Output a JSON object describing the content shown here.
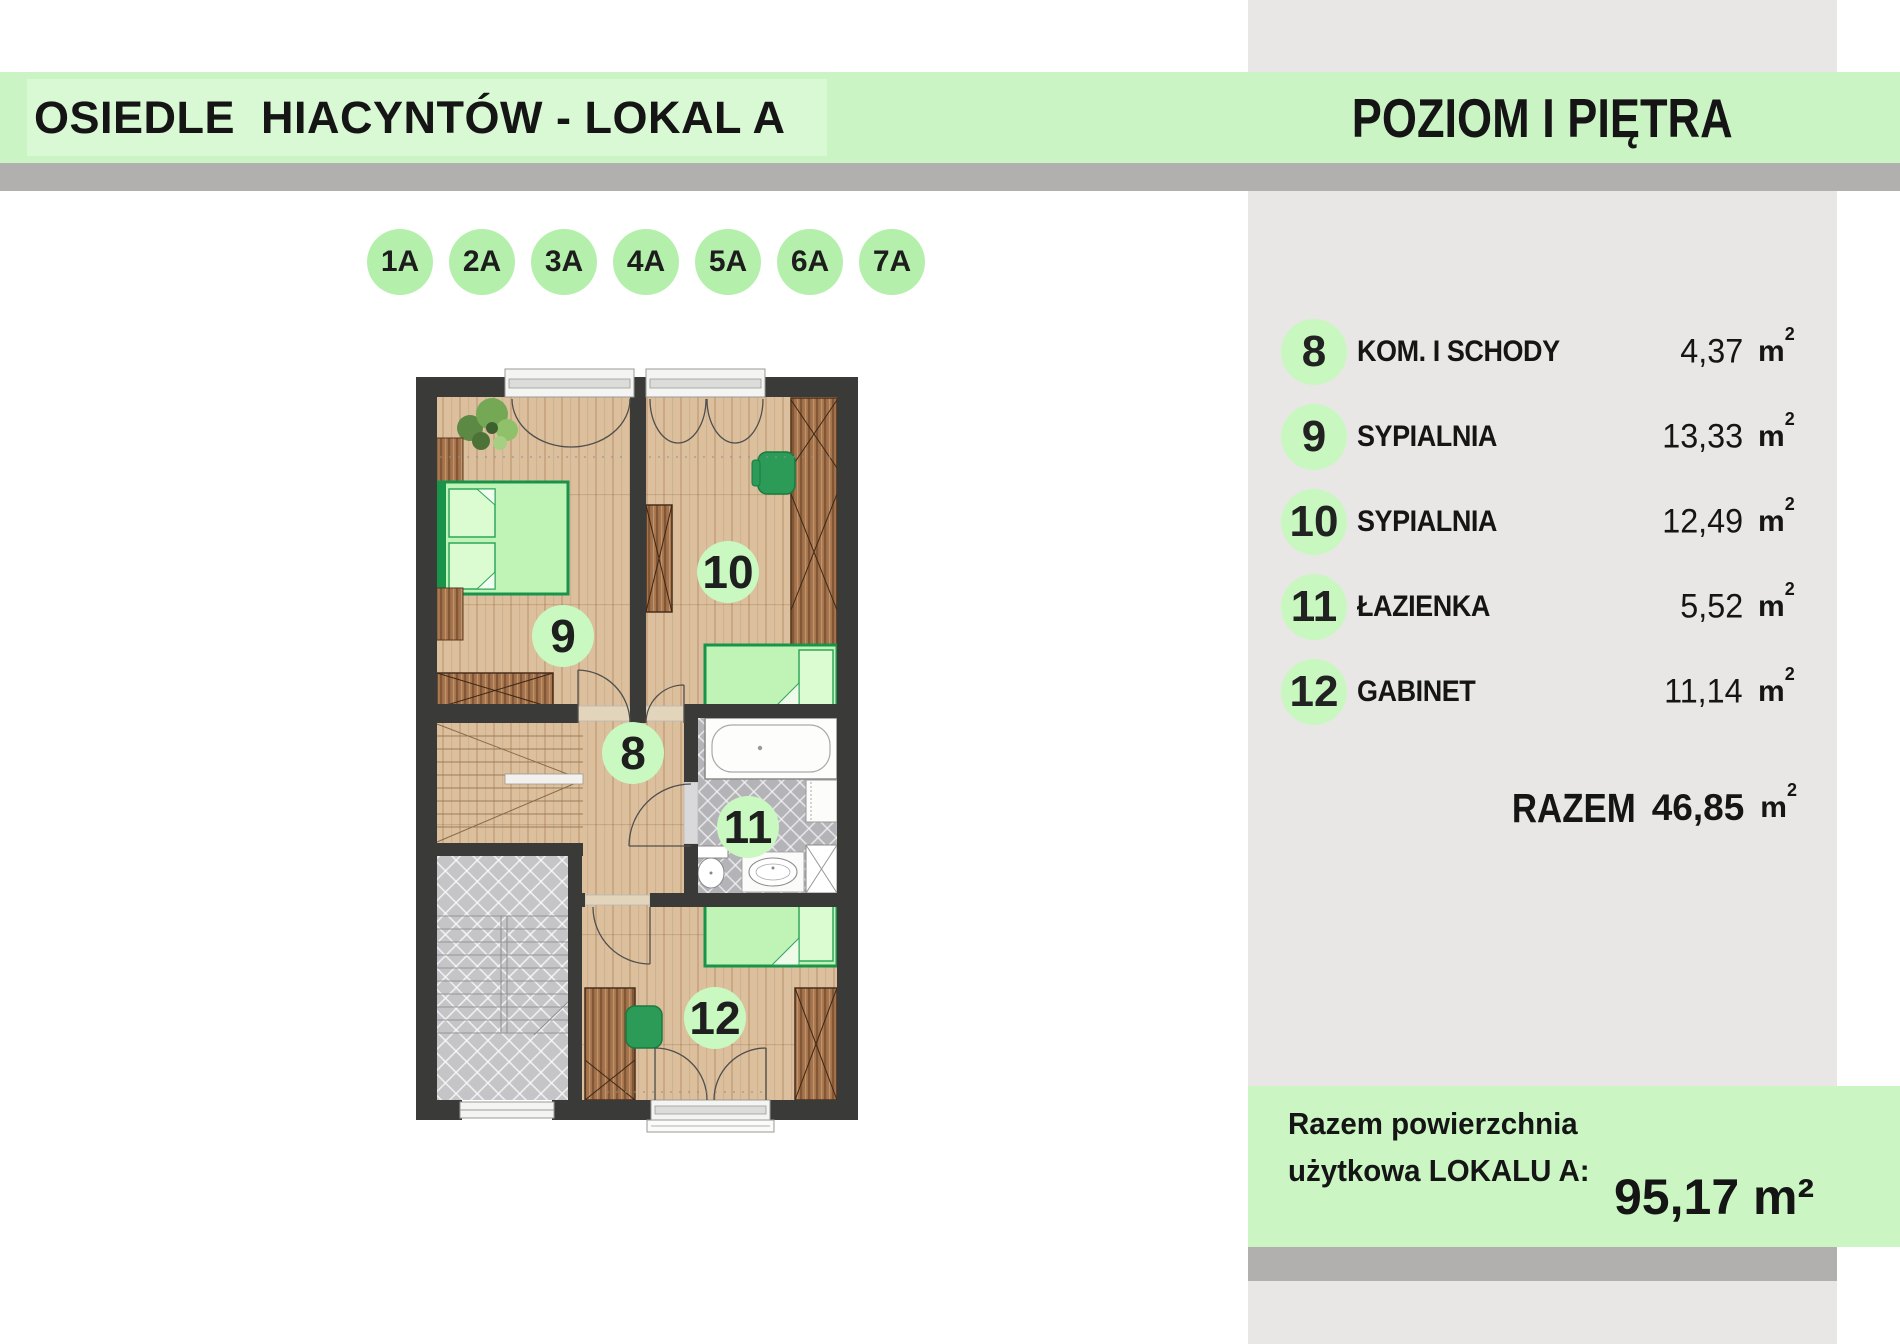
{
  "header": {
    "left_title": "OSIEDLE  HIACYNTÓW - LOKAL A",
    "right_title": "POZIOM I PIĘTRA"
  },
  "unit_badges": [
    "1A",
    "2A",
    "3A",
    "4A",
    "5A",
    "6A",
    "7A"
  ],
  "rooms": [
    {
      "num": "8",
      "label": "KOM. I SCHODY",
      "area": "4,37",
      "unit": "m",
      "sup": "2"
    },
    {
      "num": "9",
      "label": "SYPIALNIA",
      "area": "13,33",
      "unit": "m",
      "sup": "2"
    },
    {
      "num": "10",
      "label": "SYPIALNIA",
      "area": "12,49",
      "unit": "m",
      "sup": "2"
    },
    {
      "num": "11",
      "label": "ŁAZIENKA",
      "area": "5,52",
      "unit": "m",
      "sup": "2"
    },
    {
      "num": "12",
      "label": "GABINET",
      "area": "11,14",
      "unit": "m",
      "sup": "2"
    }
  ],
  "total": {
    "label": "RAZEM",
    "value": "46,85",
    "unit": "m",
    "sup": "2"
  },
  "footer": {
    "line1": "Razem powierzchnia",
    "line2": "użytkowa LOKALU A:",
    "value": "95,17 m²"
  },
  "plan": {
    "circles": [
      {
        "num": "8"
      },
      {
        "num": "9"
      },
      {
        "num": "10"
      },
      {
        "num": "11"
      },
      {
        "num": "12"
      }
    ]
  },
  "colors": {
    "band_green": "#cbf4c5",
    "badge_green": "#b5efac",
    "circle_green": "#c8f8c0",
    "panel_gray": "#e8e7e5",
    "bar_gray": "#b1b0ae",
    "wall": "#3a3a38",
    "accent_green": "#17934a"
  }
}
